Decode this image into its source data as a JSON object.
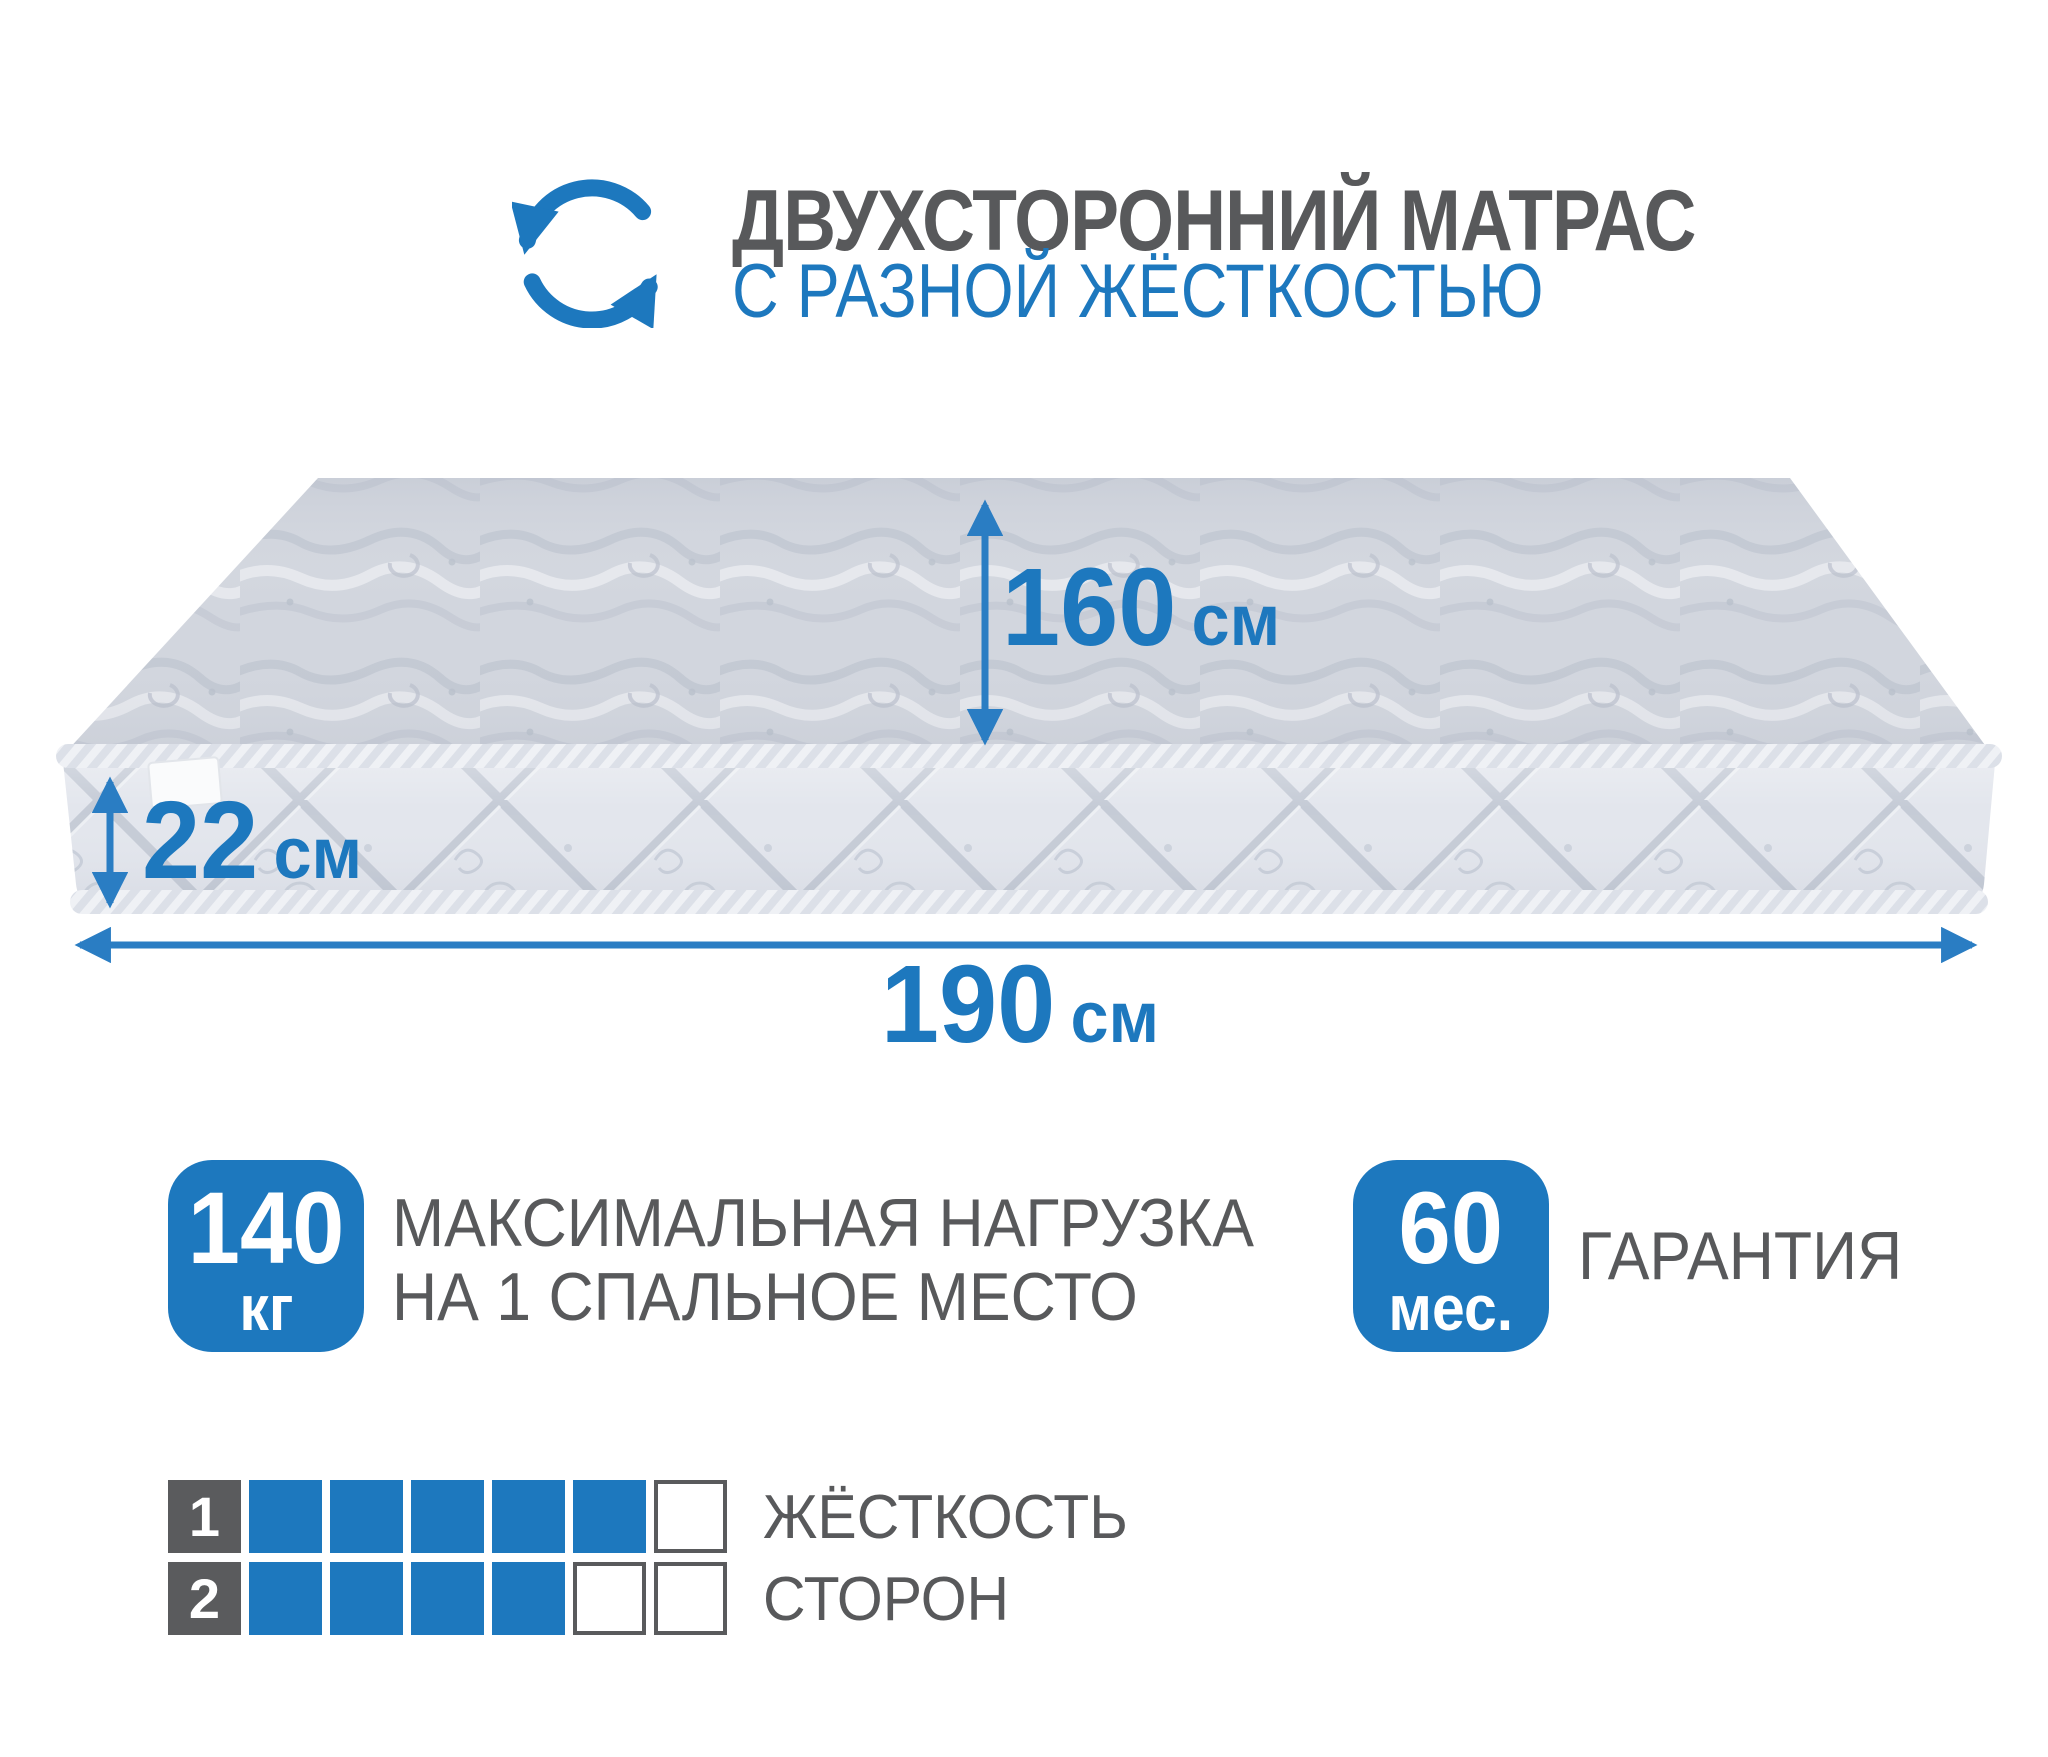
{
  "colors": {
    "blue": "#1d78be",
    "arrow_blue": "#2a7dc3",
    "text_gray": "#58595b",
    "mattress_top": "#d2d6de",
    "mattress_front": "#e3e6ed"
  },
  "header": {
    "icon": "rotate-arrows-icon",
    "title": "ДВУХСТОРОННИЙ МАТРАС",
    "subtitle": "С РАЗНОЙ ЖЁСТКОСТЬЮ"
  },
  "dimensions": {
    "depth": {
      "value": "160",
      "unit": "см"
    },
    "height": {
      "value": "22",
      "unit": "см"
    },
    "width": {
      "value": "190",
      "unit": "см"
    }
  },
  "badges": [
    {
      "value": "140",
      "unit": "кг",
      "caption_line1": "МАКСИМАЛЬНАЯ НАГРУЗКА",
      "caption_line2": "НА 1 СПАЛЬНОЕ МЕСТО"
    },
    {
      "value": "60",
      "unit": "мес.",
      "caption_line1": "ГАРАНТИЯ",
      "caption_line2": ""
    }
  ],
  "firmness": {
    "caption_line1": "ЖЁСТКОСТЬ",
    "caption_line2": "СТОРОН",
    "scale_max": 6,
    "rows": [
      {
        "number": "1",
        "filled": 5
      },
      {
        "number": "2",
        "filled": 4
      }
    ]
  }
}
